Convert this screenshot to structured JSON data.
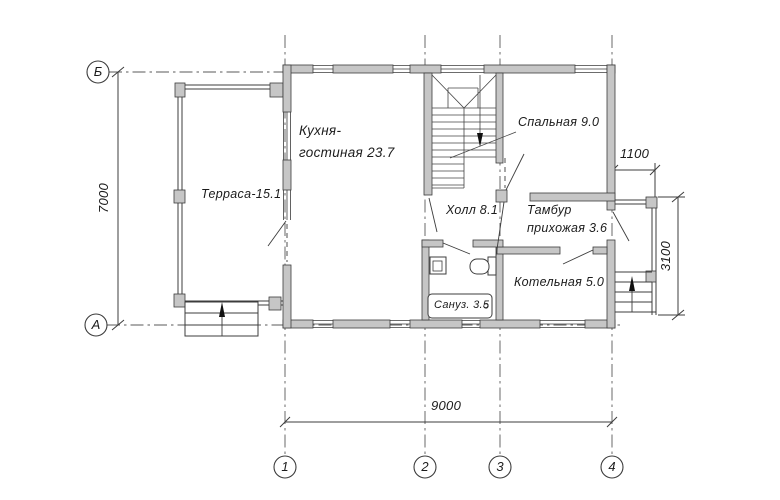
{
  "plan": {
    "title": "floor-plan-first-floor",
    "rooms": {
      "kitchen_living_line1": "Кухня-",
      "kitchen_living_line2": "гостиная 23.7",
      "terrace": "Терраса-15.1",
      "bedroom": "Спальная 9.0",
      "hall": "Холл 8.1",
      "vestibule_line1": "Тамбур",
      "vestibule_line2": "прихожая 3.6",
      "boiler_room": "Котельная 5.0",
      "bathroom": "Сануз. 3.5"
    },
    "dimensions": {
      "height_total": "7000",
      "width_total": "9000",
      "porch_width": "1100",
      "porch_height": "3100"
    },
    "axis_markers": {
      "row_b": "Б",
      "row_a": "А",
      "col_1": "1",
      "col_2": "2",
      "col_3": "3",
      "col_4": "4"
    },
    "colors": {
      "wall_fill": "#c6c6c6",
      "line": "#3c3c3c",
      "background": "#ffffff"
    }
  }
}
